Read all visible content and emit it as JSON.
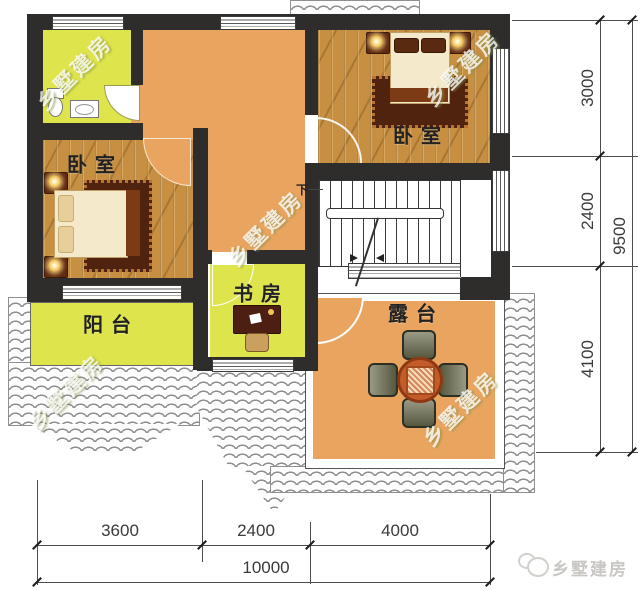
{
  "rooms": {
    "bedroom_left": {
      "label": "卧室"
    },
    "bedroom_right": {
      "label": "卧室"
    },
    "study": {
      "label": "书房"
    },
    "balcony": {
      "label": "阳台"
    },
    "terrace": {
      "label": "露台"
    }
  },
  "stairs": {
    "direction_label": "下"
  },
  "watermark": {
    "text": "乡墅建房"
  },
  "brand": {
    "name": "乡墅建房"
  },
  "dims": {
    "right": {
      "segments": [
        "3000",
        "2400",
        "4100"
      ],
      "total": "9500"
    },
    "bottom": {
      "segments": [
        "3600",
        "2400",
        "4000"
      ],
      "total": "10000"
    }
  },
  "colors": {
    "wall": "#2e2d2b",
    "floor_hall": "#e9a55f",
    "floor_room": "#dde44c",
    "wood": "#c68f41",
    "dim_text": "#3a3a3a",
    "watermark": "rgba(255,255,255,0.78)",
    "logo_gray": "#c9c7c3"
  }
}
